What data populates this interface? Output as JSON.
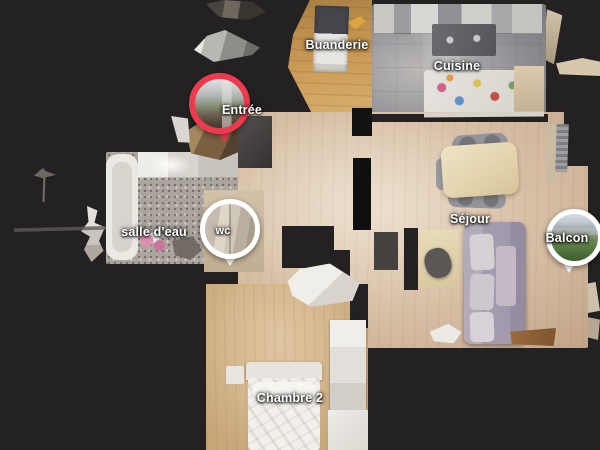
{
  "view": {
    "type": "dollhouse-floorplan-top-view"
  },
  "colors": {
    "background": "#242122",
    "pin_red": "#ee3a4d",
    "pin_white": "#ffffff",
    "label_text": "#ffffff"
  },
  "rooms": [
    {
      "id": "buanderie",
      "label": "Buanderie"
    },
    {
      "id": "cuisine",
      "label": "Cuisine"
    },
    {
      "id": "entree",
      "label": "Entrée"
    },
    {
      "id": "salle-deau",
      "label": "salle d'eau"
    },
    {
      "id": "wc",
      "label": "wc"
    },
    {
      "id": "sejour",
      "label": "Séjour"
    },
    {
      "id": "balcon",
      "label": "Balcon"
    },
    {
      "id": "chambre-2",
      "label": "Chambre 2"
    }
  ],
  "pins": [
    {
      "room": "Entrée",
      "ring_color": "#ee3a4d",
      "photo": "street-entrance-view"
    },
    {
      "room": "wc",
      "ring_color": "#ffffff",
      "photo": "bathroom-interior"
    },
    {
      "room": "Balcon",
      "ring_color": "#ffffff",
      "photo": "balcony-trees-and-buildings"
    }
  ]
}
